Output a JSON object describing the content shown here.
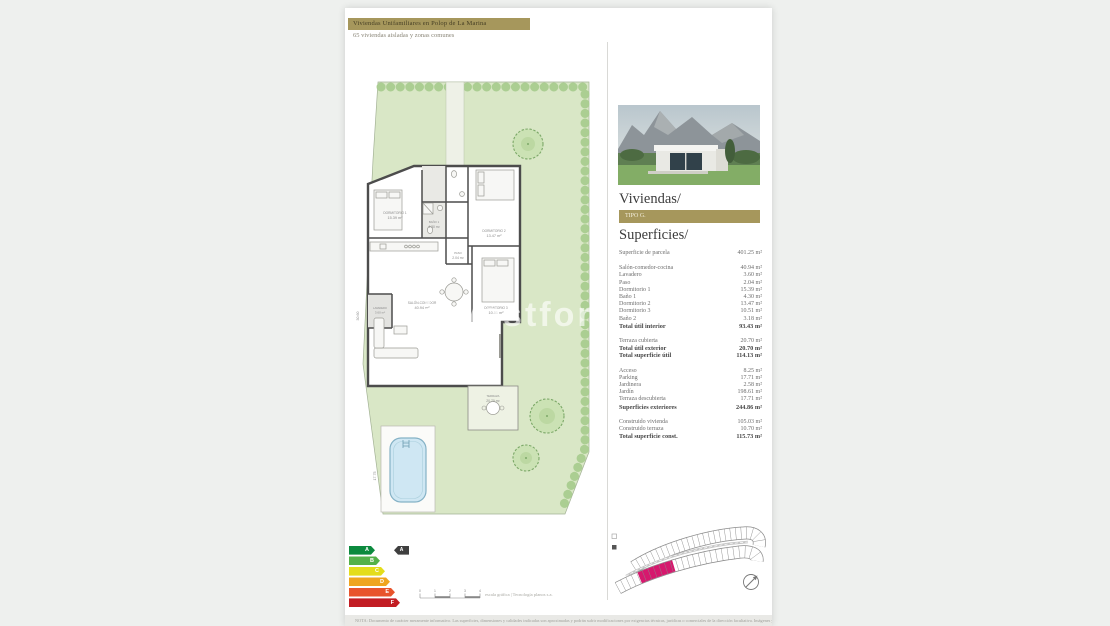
{
  "header": {
    "title": "Viviendas Unifamiliares en Polop de La Marina",
    "subtitle": "65 viviendas aisladas y zonas comunes"
  },
  "panel": {
    "viviendas_title": "Viviendas/",
    "tipo_label": "TIPO G.",
    "superficies_title": "Superficies/",
    "parcela": {
      "label": "Superficie de parcela",
      "value": "401.25 m²"
    },
    "interior_rows": [
      {
        "label": "Salón-comedor-cocina",
        "value": "40.94 m²"
      },
      {
        "label": "Lavadero",
        "value": "3.60 m²"
      },
      {
        "label": "Paso",
        "value": "2.04 m²"
      },
      {
        "label": "Dormitorio 1",
        "value": "15.39 m²"
      },
      {
        "label": "Baño 1",
        "value": "4.30 m²"
      },
      {
        "label": "Dormitorio 2",
        "value": "13.47 m²"
      },
      {
        "label": "Dormitorio 3",
        "value": "10.51 m²"
      },
      {
        "label": "Baño 2",
        "value": "3.18 m²"
      }
    ],
    "interior_total": {
      "label": "Total útil interior",
      "value": "93.43 m²"
    },
    "exterior_rows": [
      {
        "label": "Terraza cubierta",
        "value": "20.70 m²"
      }
    ],
    "exterior_total": {
      "label": "Total útil exterior",
      "value": "20.70 m²"
    },
    "util_total": {
      "label": "Total superficie útil",
      "value": "114.13 m²"
    },
    "plot_rows": [
      {
        "label": "Acceso",
        "value": "8.25 m²"
      },
      {
        "label": "Parking",
        "value": "17.71 m²"
      },
      {
        "label": "Jardinera",
        "value": "2.58 m²"
      },
      {
        "label": "Jardín",
        "value": "198.61 m²"
      },
      {
        "label": "Terraza descubierta",
        "value": "17.71 m²"
      }
    ],
    "plot_total": {
      "label": "Superficies exteriores",
      "value": "244.86 m²"
    },
    "const_rows": [
      {
        "label": "Construido vivienda",
        "value": "105.03 m²"
      },
      {
        "label": "Construido terraza",
        "value": "10.70 m²"
      }
    ],
    "const_total": {
      "label": "Total superficie const.",
      "value": "115.73 m²"
    }
  },
  "plan": {
    "watermark": "investfor",
    "rooms": [
      {
        "name": "DORMITORIO 1",
        "area": "15.39 m²"
      },
      {
        "name": "BAÑO 1",
        "area": "4.30 m²"
      },
      {
        "name": "DORMITORIO 2",
        "area": "13.47 m²"
      },
      {
        "name": "PASO",
        "area": "2.04 m²"
      },
      {
        "name": "DORMITORIO 3",
        "area": "10.51 m²"
      },
      {
        "name": "SALÓN-COMEDOR",
        "area": "40.94 m²"
      },
      {
        "name": "LAVADERO",
        "area": "3.60 m²"
      },
      {
        "name": "TERRAZA",
        "area": "20.70 m²"
      }
    ],
    "dims": [
      "30.60",
      "17.75"
    ]
  },
  "energy": {
    "letters": [
      "A",
      "B",
      "C",
      "D",
      "E",
      "F"
    ],
    "colors": [
      "#0c8a3e",
      "#54b14a",
      "#e4dd1b",
      "#efa51f",
      "#e8542c",
      "#c21d23"
    ],
    "indicator": "A"
  },
  "scalebar": {
    "ticks": [
      "0",
      "1",
      "2",
      "3",
      "4"
    ],
    "credit": "escala gráfica | Tecnología planos s.a."
  },
  "siteplan": {
    "highlight_color": "#d6186e"
  },
  "footer": {
    "disclaimer": "NOTA: Documento de carácter meramente informativo. Las superficies, dimensiones y calidades indicadas son aproximadas y podrán sufrir modificaciones por exigencias técnicas, jurídicas o comerciales de la dirección facultativa. Imágenes y planos no contractuales."
  }
}
